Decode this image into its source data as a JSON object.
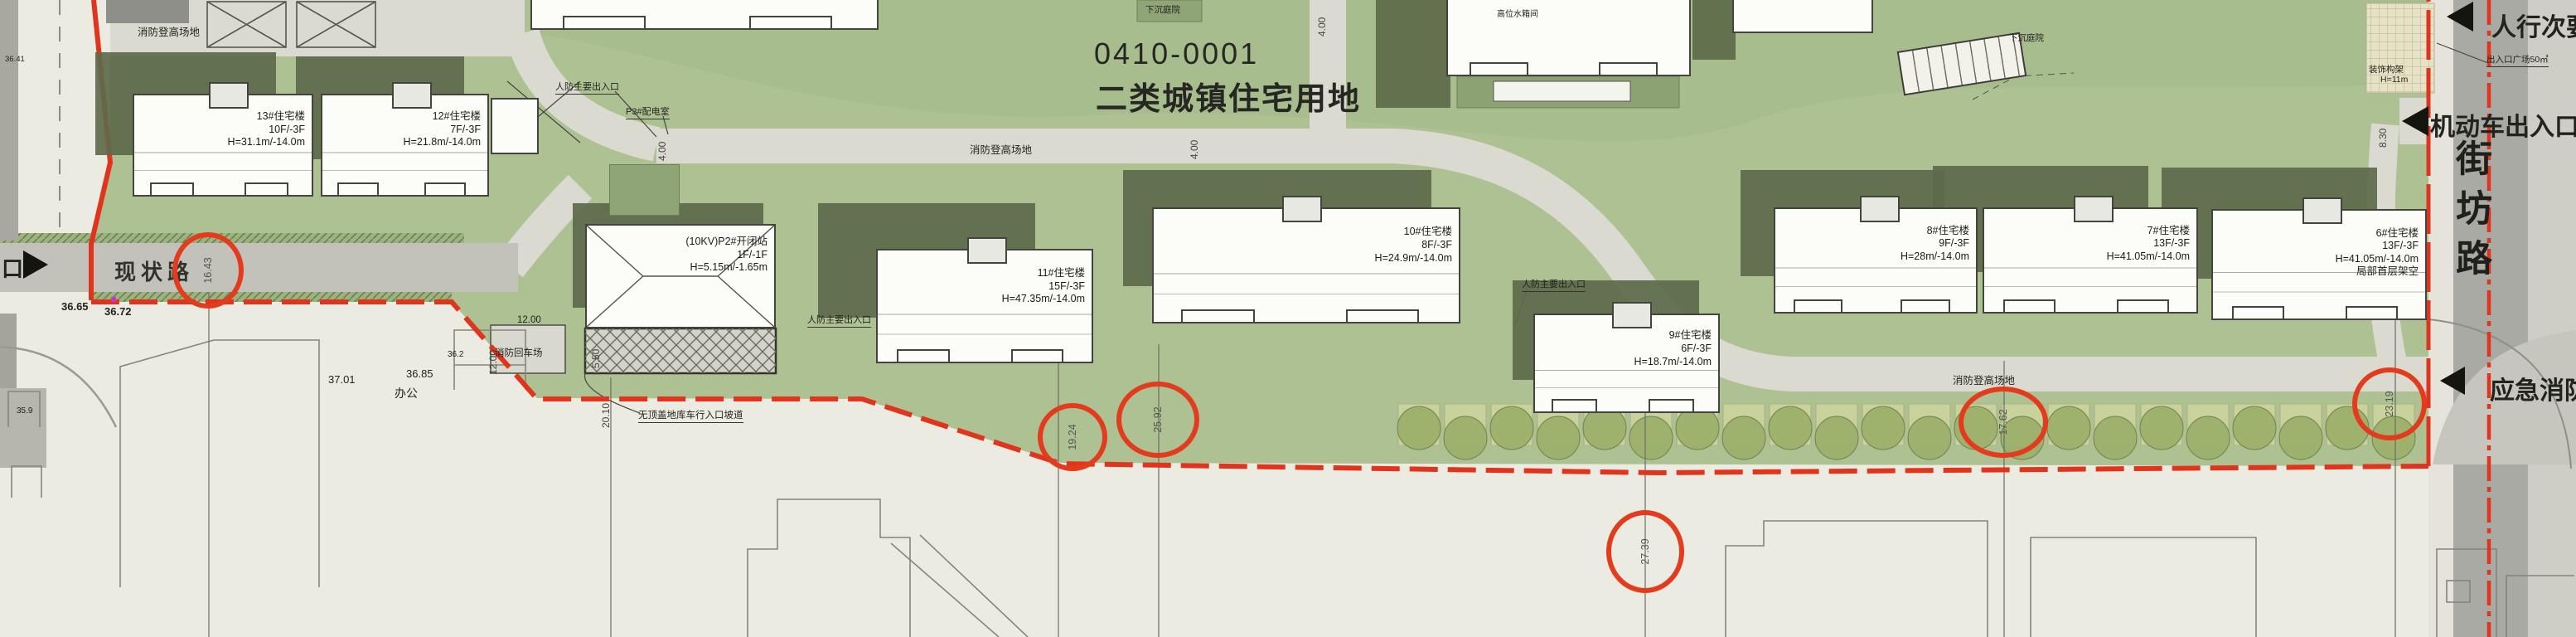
{
  "title": {
    "code": "0410-0001",
    "use": "二类城镇住宅用地"
  },
  "roads": {
    "existing": "现状路",
    "fang": "街坊路"
  },
  "edge": {
    "pedestrian": "人行次要",
    "plaza": "出入口广场50㎡",
    "motor": "机动车出入口",
    "emergency": "应急消防",
    "mouth": "口"
  },
  "buildings": [
    {
      "name": "13#住宅楼",
      "floors": "10F/-3F",
      "height": "H=31.1m/-14.0m"
    },
    {
      "name": "12#住宅楼",
      "floors": "7F/-3F",
      "height": "H=21.8m/-14.0m"
    },
    {
      "name": "(10KV)P2#开闭站",
      "floors": "1F/-1F",
      "height": "H=5.15m/-1.65m"
    },
    {
      "name": "11#住宅楼",
      "floors": "15F/-3F",
      "height": "H=47.35m/-14.0m"
    },
    {
      "name": "10#住宅楼",
      "floors": "8F/-3F",
      "height": "H=24.9m/-14.0m"
    },
    {
      "name": "9#住宅楼",
      "floors": "6F/-3F",
      "height": "H=18.7m/-14.0m"
    },
    {
      "name": "8#住宅楼",
      "floors": "9F/-3F",
      "height": "H=28m/-14.0m"
    },
    {
      "name": "7#住宅楼",
      "floors": "13F/-3F",
      "height": "H=41.05m/-14.0m"
    },
    {
      "name": "6#住宅楼",
      "floors": "13F/-3F",
      "height": "H=41.05m/-14.0m",
      "note": "局部首层架空"
    }
  ],
  "ann": {
    "fire_lane": "消防登高场地",
    "sunken": "下沉庭院",
    "civil_def": "人防主要出入口",
    "power": "P3#配电室",
    "tank": "高位水箱间",
    "turnaround": "消防回车场",
    "ramp": "无顶盖地库车行入口坡道",
    "deco1": "装饰构架",
    "deco2": "H=11m",
    "office": "办公"
  },
  "elev": {
    "a": "36.65",
    "b": "36.72",
    "c": "37.01",
    "d": "36.85",
    "e": "36.41",
    "f": "35.9",
    "g": "36.2"
  },
  "dims": {
    "d400": "4.00",
    "d1200": "12.00",
    "d550": "5.50",
    "d830": "8.30",
    "d2010": "20.10"
  },
  "circled": [
    "16.43",
    "19.24",
    "25.92",
    "27.39",
    "17.62",
    "23.19"
  ]
}
